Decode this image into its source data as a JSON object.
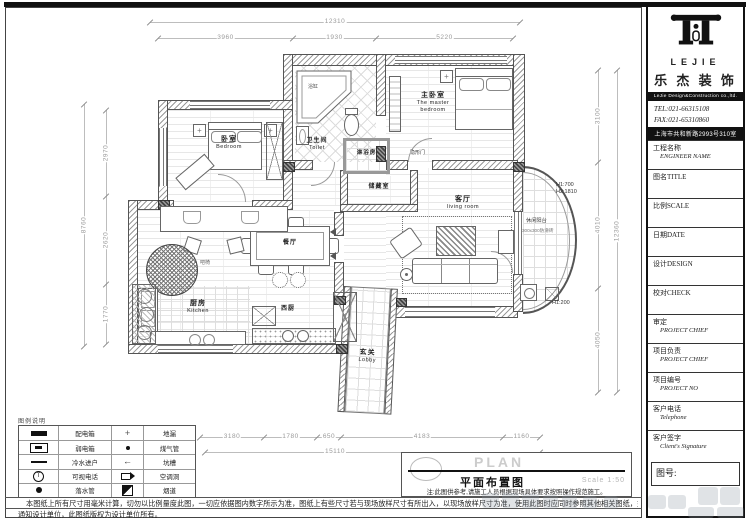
{
  "titleblock": {
    "plan": "PLAN",
    "title": "平面布置图",
    "scale": "Scale 1:50",
    "note": "注:此图供参考,请施工人员根据现场具体要求按照操作规范施工。"
  },
  "notes": {
    "line1": "本图纸上所有尺寸用毫米计算，切勿以比例量度此图，一切应依据图内数字所示为准，图纸上有些尺寸若与现场放样尺寸有所出入，以现场放样尺寸为准，使用此图时应同时参照其他相关图纸，如发现有差异处，应立刻",
    "line2": "通知设计单位，此图纸版权为设计单位所有。"
  },
  "legend": {
    "title": "图例说明",
    "rows": [
      {
        "l_icon": "distribution-box",
        "l_label": "配电箱",
        "r_icon": "floor-drain",
        "r_label": "地漏"
      },
      {
        "l_icon": "weak-current-box",
        "l_label": "弱电箱",
        "r_icon": "gas-pipe",
        "r_label": "煤气管"
      },
      {
        "l_icon": "cold-water-inlet",
        "l_label": "冷水进户",
        "r_icon": "trough",
        "r_label": "坑槽"
      },
      {
        "l_icon": "video-phone",
        "l_label": "可视电话",
        "r_icon": "ac-hole",
        "r_label": "空调洞"
      },
      {
        "l_icon": "downpipe",
        "l_label": "落水管",
        "r_icon": "flue",
        "r_label": "烟道"
      }
    ]
  },
  "sidebar": {
    "logo_text": "LEJIE",
    "company_cn": "乐 杰 装 饰",
    "company_en": "LeJie  Design&Construction co.,ltd.",
    "tel": "TEL:021-66315108",
    "fax": "FAX:021-65310860",
    "address": "上海市共和新路2993号310室",
    "rows": [
      {
        "cn": "工程名称",
        "en": "ENGINEER NAME"
      },
      {
        "cn": "图名TITLE",
        "en": ""
      },
      {
        "cn": "比例SCALE",
        "en": ""
      },
      {
        "cn": "日期DATE",
        "en": ""
      },
      {
        "cn": "设计DESIGN",
        "en": ""
      },
      {
        "cn": "校对CHECK",
        "en": ""
      },
      {
        "cn": "审定",
        "en": "PROJECT CHIEF"
      },
      {
        "cn": "项目负责",
        "en": "PROJECT CHIEF"
      },
      {
        "cn": "项目编号",
        "en": "PROJECT NO"
      },
      {
        "cn": "客户电话",
        "en": "Telephone"
      },
      {
        "cn": "客户签字",
        "en": "Client's Signature"
      }
    ],
    "drawing_no_label": "图号:"
  },
  "rooms": {
    "bedroom": {
      "cn": "卧室",
      "en": "Bedroom"
    },
    "toilet": {
      "cn": "卫生间",
      "en": "Toilet"
    },
    "shower": {
      "cn": "淋浴房"
    },
    "master": {
      "cn": "主卧室",
      "en": "The master bedroom"
    },
    "storage": {
      "cn": "储藏室"
    },
    "living": {
      "cn": "客厅",
      "en": "living room"
    },
    "dining": {
      "cn": "餐厅"
    },
    "kitchen": {
      "cn": "厨房",
      "en": "Kitchen"
    },
    "west_kitchen": {
      "cn": "西厨"
    },
    "lobby": {
      "cn": "玄关",
      "en": "Lobby"
    },
    "balcony": {
      "cn": "休闲阳台",
      "tile": "300x300防滑砖"
    }
  },
  "annotations": {
    "h1_700": "H1:700",
    "h2_1810": "H2:1810",
    "h1_200": "H1:200",
    "hidden_door": "隐形门",
    "bathtub": "浴缸",
    "rattan_chair": "吧椅"
  },
  "dimensions": {
    "top": {
      "overall": "12310",
      "segments": [
        "3960",
        "1930",
        "5220"
      ]
    },
    "left": {
      "overall": "8760",
      "segments": [
        "2970",
        "2620",
        "1770"
      ]
    },
    "right": {
      "overall": "12360",
      "segments": [
        "3100",
        "4010",
        "4050"
      ]
    },
    "bottom": {
      "overall": "15110",
      "segments": [
        "3180",
        "1780",
        "650",
        "4183",
        "1160"
      ]
    }
  }
}
